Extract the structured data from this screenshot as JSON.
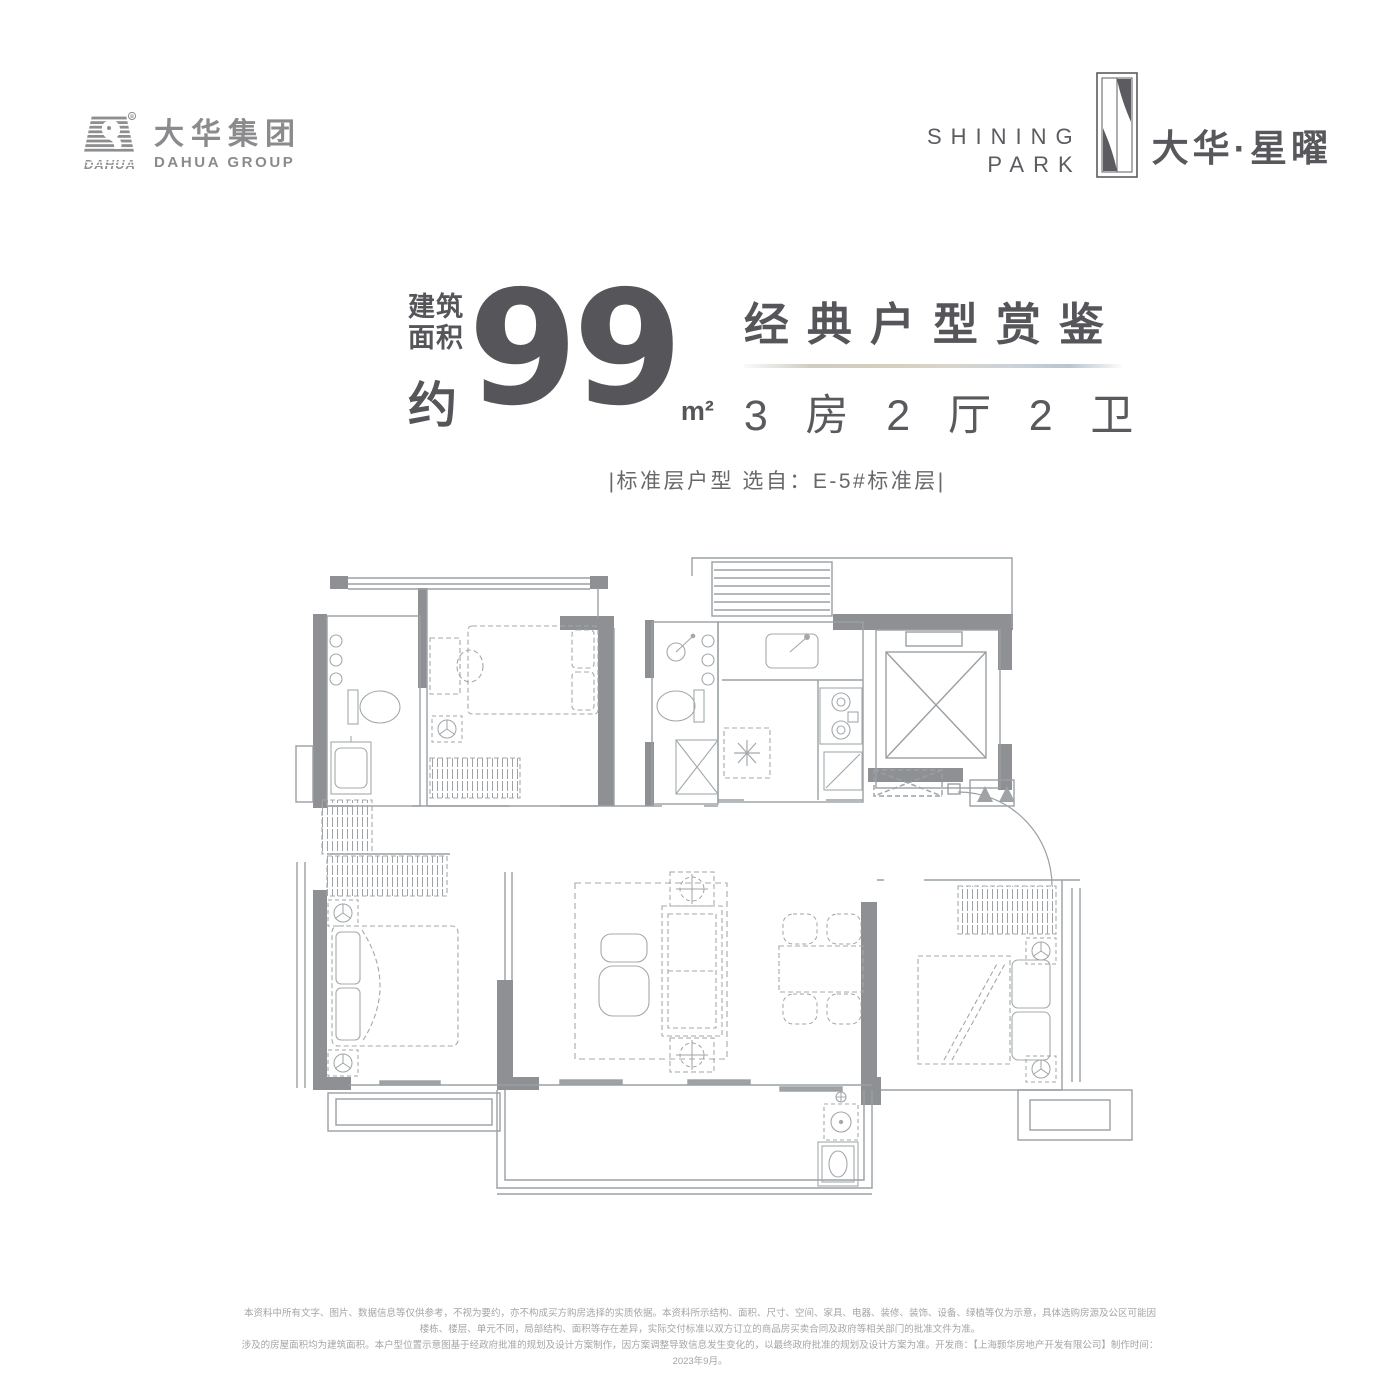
{
  "brand": {
    "dahua": {
      "cn": "大华集团",
      "en": "DAHUA GROUP",
      "mark_text": "DAHUA",
      "registered": "®"
    },
    "project": {
      "en_line1": "SHINING",
      "en_line2": "PARK",
      "cn": "大华·星曜"
    }
  },
  "title": {
    "area_prefix_1": "建筑",
    "area_prefix_2": "面积",
    "area_prefix_3": "约",
    "area_value": "99",
    "area_unit": "m²",
    "headline": "经典户型赏鉴",
    "spec": "3 房 2 厅 2 卫",
    "subtitle": "|标准层户型  选自：E-5#标准层|"
  },
  "disclaimer": {
    "line1": "本资料中所有文字、图片、数据信息等仅供参考，不视为要约，亦不构成买方购房选择的实质依据。本资料所示结构、面积、尺寸、空间、家具、电器、装修、装饰、设备、绿植等仅为示意，具体选购房源及公区可能因楼栋、楼层、单元不同，局部结构、面积等存在差异，实际交付标准以双方订立的商品房买卖合同及政府等相关部门的批准文件为准。",
    "line2": "涉及的房屋面积均为建筑面积。本户型位置示意图基于经政府批准的规划及设计方案制作，因方案调整导致信息发生变化的，以最终政府批准的规划及设计方案为准。开发商：【上海颢华房地产开发有限公司】制作时间：2023年9月。"
  },
  "colors": {
    "title_text": "#56565a",
    "logo_gray": "#8b8b8d",
    "project_logo": "#5c5c60",
    "plan_wall": "#8e9093",
    "plan_line": "#9aa0a4",
    "plan_furniture": "#a4a8ab",
    "disclaimer_text": "#a5a5a7"
  }
}
